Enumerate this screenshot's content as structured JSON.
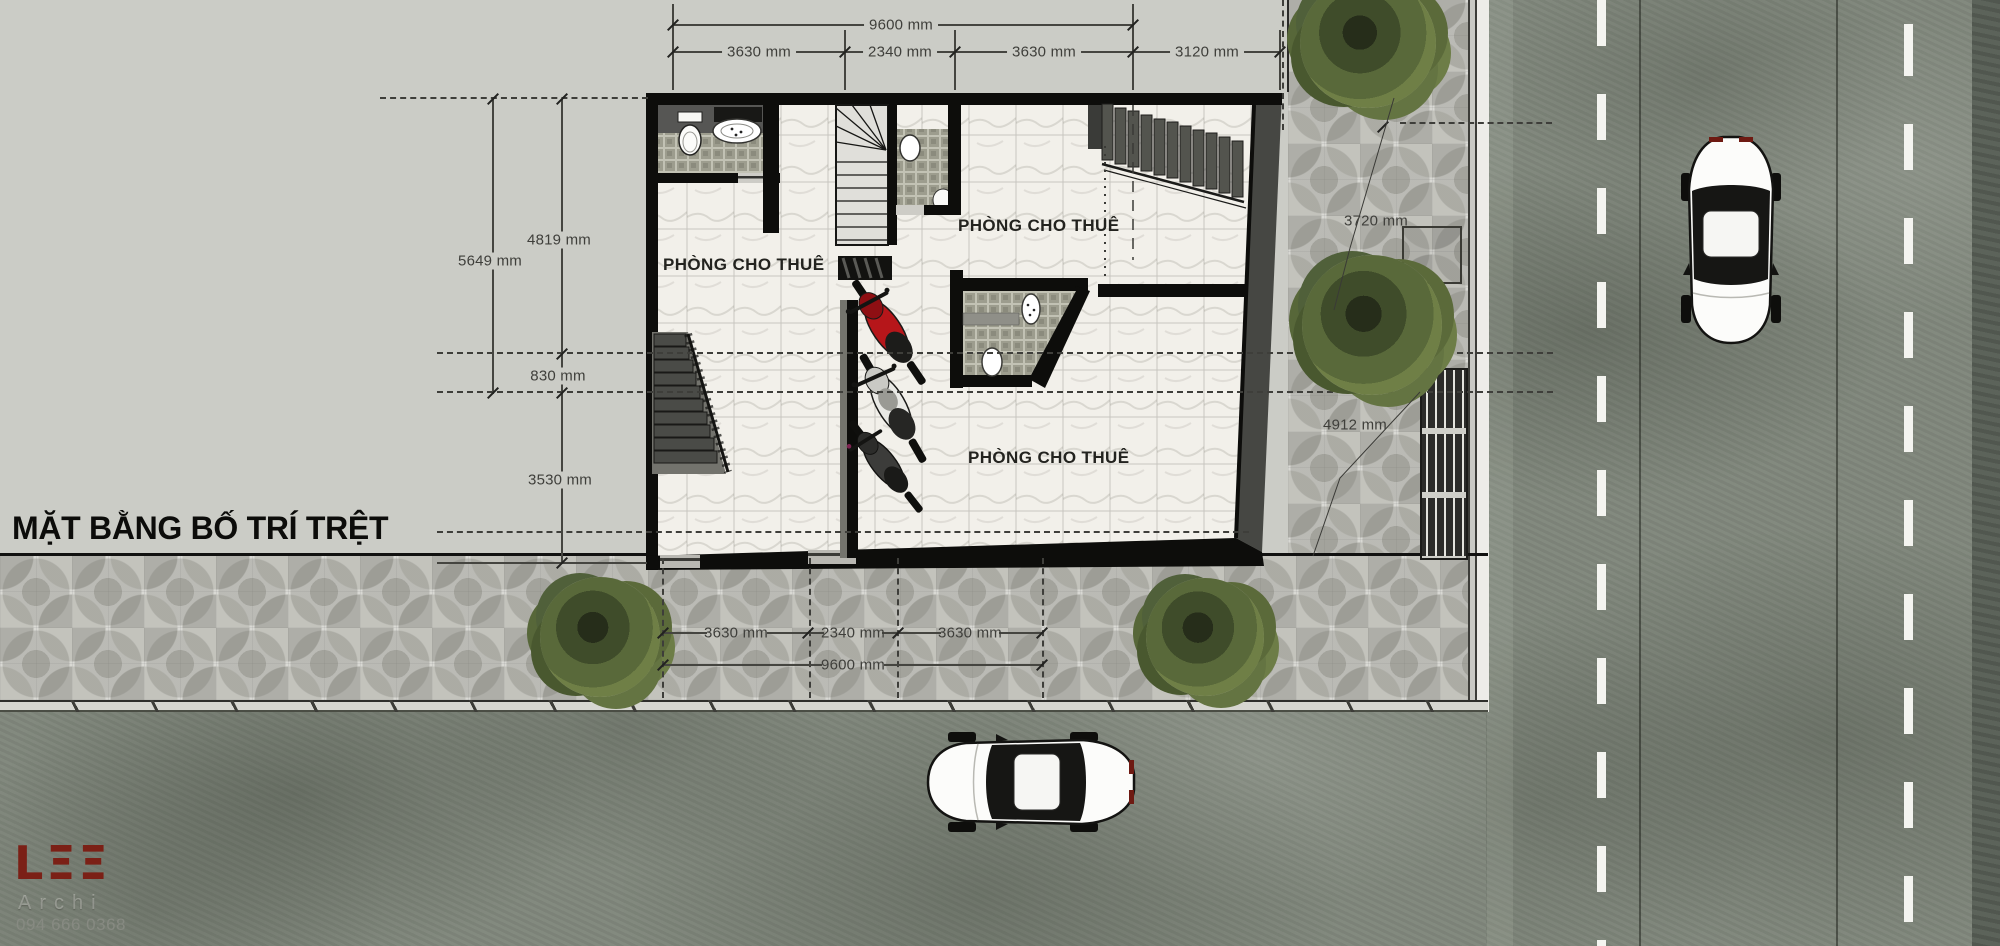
{
  "title": "MẶT BẰNG BỐ TRÍ TRỆT",
  "rooms": {
    "r1": "PHÒNG CHO THUÊ",
    "r2": "PHÒNG CHO THUÊ",
    "r3": "PHÒNG CHO THUÊ"
  },
  "dims": {
    "top": {
      "overall": "9600 mm",
      "seg1": "3630 mm",
      "seg2": "2340 mm",
      "seg3": "3630 mm",
      "seg4": "3120 mm"
    },
    "left": {
      "d1": "4819 mm",
      "d2": "5649 mm",
      "d3": "830 mm",
      "d4": "3530 mm"
    },
    "right": {
      "d1": "3720 mm",
      "d2": "4912 mm"
    },
    "bottom": {
      "seg1": "3630 mm",
      "seg2": "2340 mm",
      "seg3": "3630 mm",
      "overall": "9600 mm"
    }
  },
  "logo": {
    "mark": "LΞΞ",
    "sub": "Archi",
    "phone": "094 666 0368"
  },
  "colors": {
    "logo_red": "#7b2016",
    "lot": "#cbccc6",
    "pavement": "#d9d9d4",
    "asphalt": "#7f867b",
    "wall": "#0d0d0b",
    "bike_red": "#b6161a"
  }
}
